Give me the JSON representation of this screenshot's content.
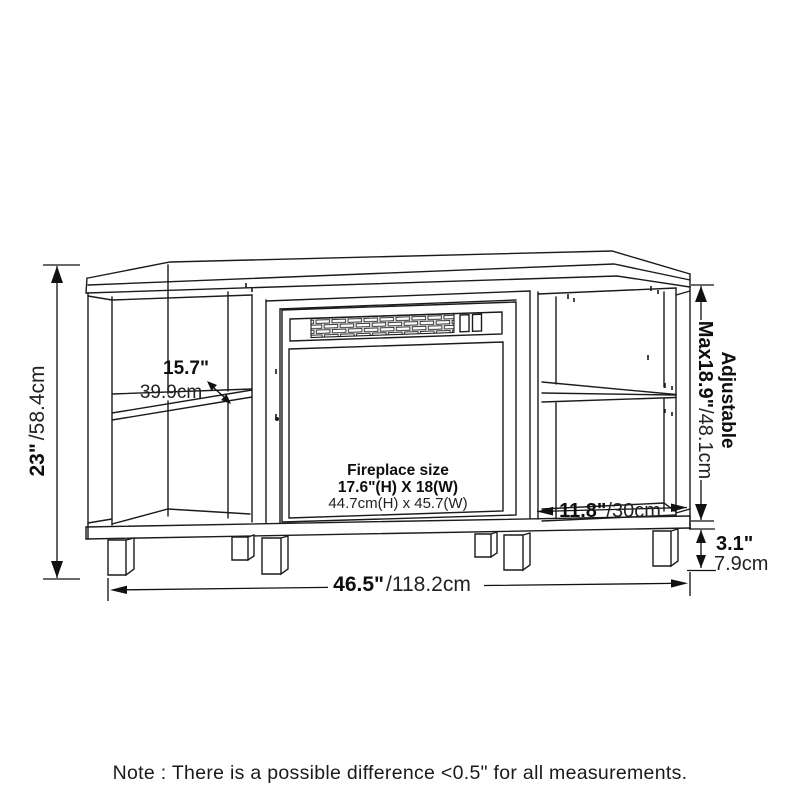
{
  "annotations": {
    "height": {
      "inches": "23\"",
      "metric": "/58.4cm"
    },
    "shelf_left": {
      "inches": "15.7\"",
      "metric": "39.9cm"
    },
    "adjustable": {
      "label": "Adjustable",
      "inches": "Max18.9\"",
      "metric": "/48.1cm"
    },
    "shelf_right": {
      "inches": "11.8\"",
      "metric": "/30cm"
    },
    "leg_height": {
      "inches": "3.1\"",
      "metric": "7.9cm"
    },
    "width": {
      "inches": "46.5\"",
      "metric": "/118.2cm"
    }
  },
  "fireplace": {
    "title": "Fireplace size",
    "size_imperial": "17.6\"(H) X 18(W)",
    "size_metric": "44.7cm(H) x 45.7(W)"
  },
  "note": "Note : There is a possible difference <0.5\" for all measurements."
}
